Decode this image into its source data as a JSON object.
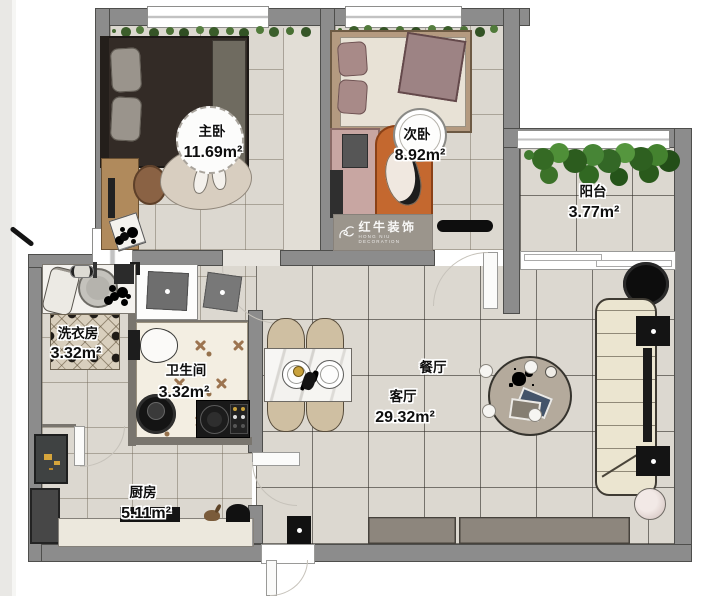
{
  "brand": {
    "logo_text": "红牛装饰",
    "logo_sub": "HONG NIU DECORATION"
  },
  "rooms": {
    "master_bedroom": {
      "name": "主卧",
      "area": "11.69m²"
    },
    "second_bedroom": {
      "name": "次卧",
      "area": "8.92m²"
    },
    "balcony": {
      "name": "阳台",
      "area": "3.77m²"
    },
    "laundry": {
      "name": "洗衣房",
      "area": "3.32m²"
    },
    "bathroom": {
      "name": "卫生间",
      "area": "3.32m²"
    },
    "dining": {
      "name": "餐厅"
    },
    "living": {
      "name": "客厅",
      "area": "29.32m²"
    },
    "kitchen": {
      "name": "厨房",
      "area": "5.11m²"
    }
  },
  "colors": {
    "wall": "#8c8c8c",
    "floor": "#dcd8d0",
    "bath_floor": "#f3eee2",
    "sofa": "#ebe5d0",
    "rug_orange": "#c4682f",
    "plant_green": "#3f7a2e",
    "watermark_bg": "#9b958c"
  }
}
